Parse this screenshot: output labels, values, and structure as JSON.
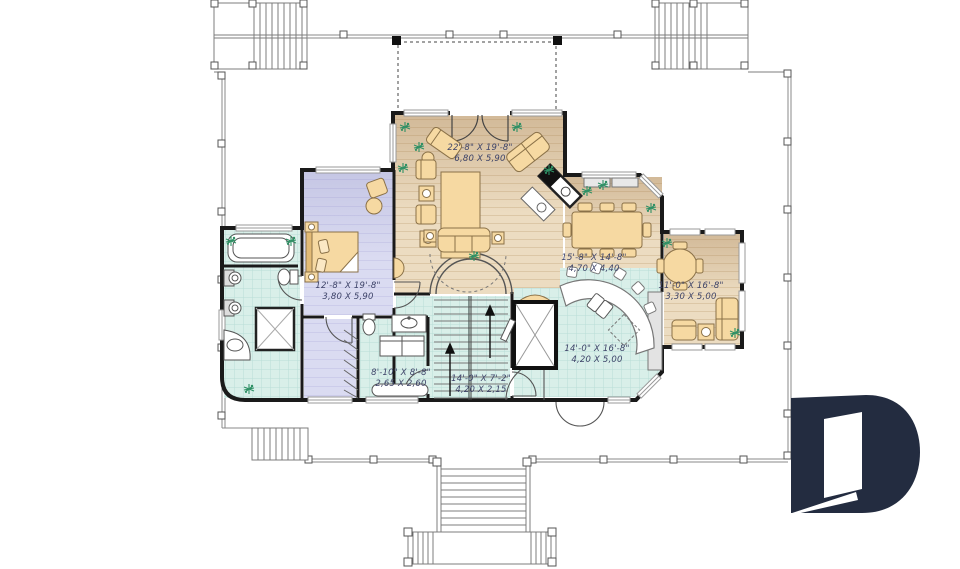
{
  "colors": {
    "wall": "#1a1a1a",
    "wood_floor": "#ecdcc1",
    "wood_line": "#dcc7a6",
    "tile_floor": "#d9efe9",
    "tile_line": "#b9ded6",
    "bedroom_floor": "#dadbf1",
    "furniture": "#f6d9a2",
    "plant": "#2f9065",
    "label_text": "#3d4368",
    "logo": "#232c40"
  },
  "rooms": [
    {
      "name": "living-room",
      "imperial": "22'-8\" X 19'-8\"",
      "metric": "6,80 X 5,90"
    },
    {
      "name": "dining-room",
      "imperial": "15'-8\" X 14'-8\"",
      "metric": "4,70 X 4,40"
    },
    {
      "name": "breakfast-nook",
      "imperial": "11'-0\" X 16'-8\"",
      "metric": "3,30 X 5,00"
    },
    {
      "name": "master-bedroom",
      "imperial": "12'-8\" X 19'-8\"",
      "metric": "3,80 X 5,90"
    },
    {
      "name": "kitchen",
      "imperial": "14'-0\" X 16'-8\"",
      "metric": "4,20 X 5,00"
    },
    {
      "name": "laundry-room",
      "imperial": "8'-10\" X 8'-8\"",
      "metric": "2,65 X 2,60"
    },
    {
      "name": "hall-stairs",
      "imperial": "14'-0\" X 7'-2\"",
      "metric": "4,20 X 2,15"
    }
  ],
  "fixtures": [
    "bathtub",
    "shower",
    "toilet",
    "pedestal-sinks",
    "bed",
    "closet-rod",
    "washer-dryer",
    "dining-table",
    "round-table",
    "sofa",
    "armchair",
    "curved-kitchen-island",
    "bar-stools",
    "kitchen-sink",
    "dishwasher",
    "corner-fireplace",
    "staircase-up",
    "arched-opening",
    "double-entry-door",
    "deck-stairs",
    "porch-railing",
    "front-steps",
    "upper-deck-outline"
  ],
  "logo": {
    "name": "drummond-d-logo",
    "color": "#232c40"
  }
}
